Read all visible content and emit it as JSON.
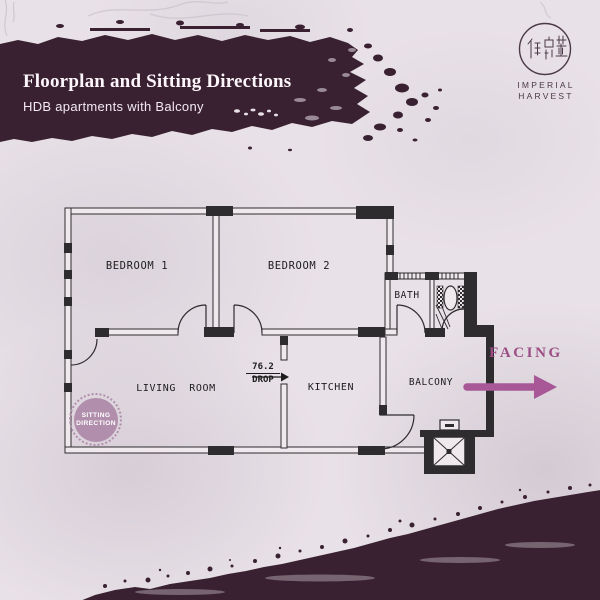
{
  "page": {
    "background_color": "#e8e1e7",
    "brush_color": "#3a2132"
  },
  "header": {
    "title": "Floorplan and Sitting Directions",
    "subtitle": "HDB apartments with Balcony"
  },
  "brand": {
    "logo_characters": "御鼎豐",
    "name_line1": "IMPERIAL",
    "name_line2": "HARVEST",
    "color": "#4b3947"
  },
  "floorplan": {
    "rooms": {
      "bedroom1": "BEDROOM 1",
      "bedroom2": "BEDROOM 2",
      "bath": "BATH",
      "living_room": "LIVING  ROOM",
      "kitchen": "KITCHEN",
      "balcony": "BALCONY"
    },
    "drop_annotation": {
      "value": "76.2",
      "label": "DROP"
    }
  },
  "annotations": {
    "sitting_badge": {
      "line1": "SITTING",
      "line2": "DIRECTION",
      "color": "#b18fac"
    },
    "facing": {
      "label": "FACING",
      "text_color": "#9b4d84",
      "arrow_color": "#a85897"
    }
  }
}
